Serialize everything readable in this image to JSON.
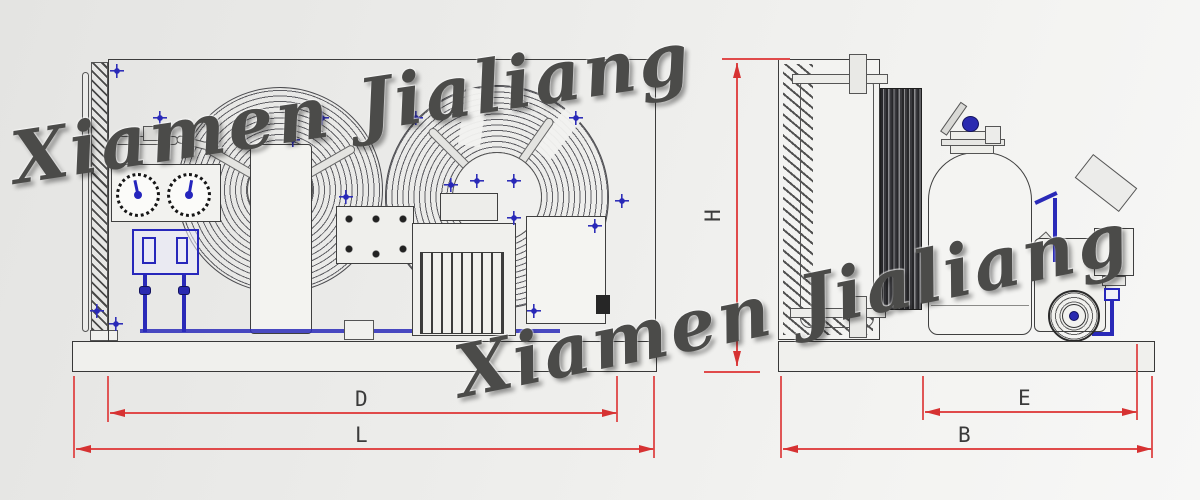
{
  "document": {
    "type": "engineering-drawing",
    "subject": "air-cooled condensing unit, front and side orthographic views"
  },
  "watermark": {
    "text": "Xiamen Jialiang"
  },
  "dimension_labels": {
    "D": "D",
    "L": "L",
    "H": "H",
    "E": "E",
    "B": "B"
  },
  "views": {
    "front": {
      "dimensions": [
        "D",
        "L"
      ],
      "components": [
        "condenser-coil",
        "axial-fan-left",
        "axial-fan-right",
        "pressure-gauge-high",
        "pressure-gauge-low",
        "dual-pressure-switch",
        "filter-drier",
        "compressor",
        "electrical-box",
        "base-frame"
      ]
    },
    "side": {
      "dimensions": [
        "H",
        "E",
        "B"
      ],
      "components": [
        "condenser-coil",
        "fan-motor-column",
        "liquid-receiver",
        "receiver-shutoff-valve",
        "compressor",
        "flywheel-pulley",
        "oil-separator",
        "base-frame"
      ]
    }
  },
  "colors": {
    "background": "#ececea",
    "line_dark": "#3c3c3c",
    "accent_blue": "#2a2ab8",
    "dimension_red": "#e04a4a",
    "watermark_gray": "#4b4b49"
  }
}
